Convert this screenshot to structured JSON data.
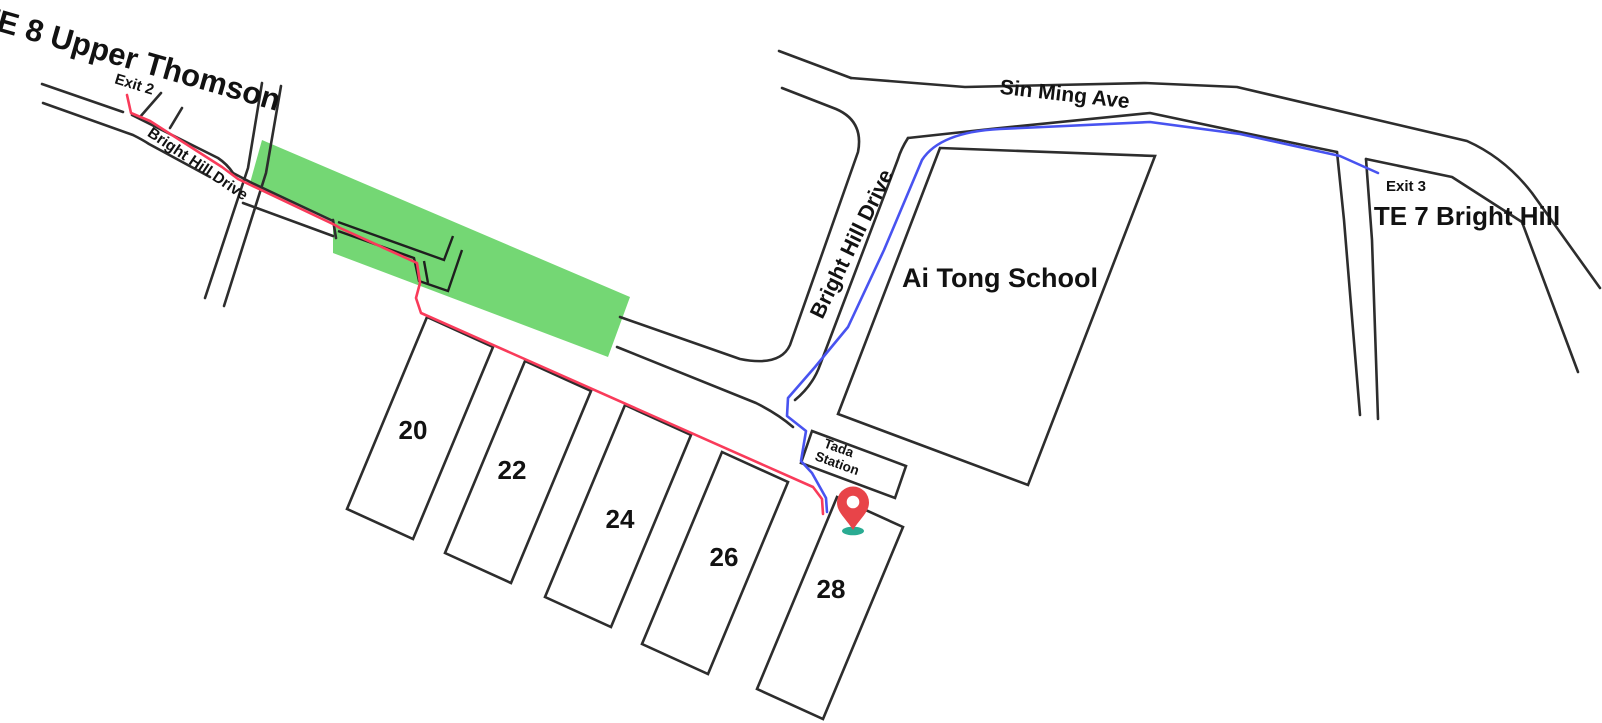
{
  "map": {
    "stations": {
      "te8": {
        "name": "TE 8 Upper Thomson",
        "exit_label": "Exit 2"
      },
      "te7": {
        "name": "TE 7 Bright Hill",
        "exit_label": "Exit 3"
      }
    },
    "roads": {
      "bright_hill_drive_nw": "Bright Hill Drive",
      "bright_hill_drive": "Bright Hill Drive",
      "sin_ming_ave": "Sin Ming Ave"
    },
    "places": {
      "school": "Ai Tong School",
      "tada_station": {
        "line1": "Tada",
        "line2": "Station"
      }
    },
    "buildings": [
      "20",
      "22",
      "24",
      "26",
      "28"
    ],
    "colors": {
      "station_area": "#74d774",
      "route_te8": "#f93b5a",
      "route_te7": "#4853f0",
      "road_line": "#2d2d2d",
      "pin": "#e84449",
      "pin_base": "#2aab92"
    }
  }
}
